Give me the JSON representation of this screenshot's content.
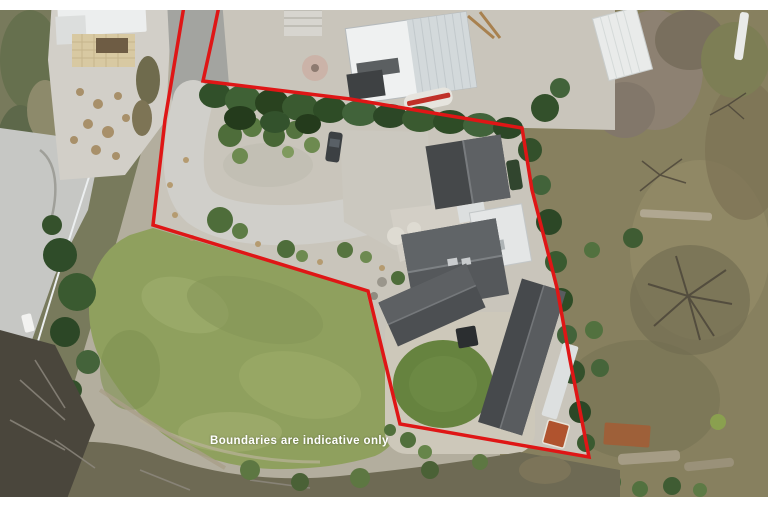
{
  "overlay": {
    "disclaimer": "Boundaries are indicative only",
    "boundary_color": "#df1616",
    "text_color": "#ffffff",
    "letterbox_color": "#ffffff"
  }
}
